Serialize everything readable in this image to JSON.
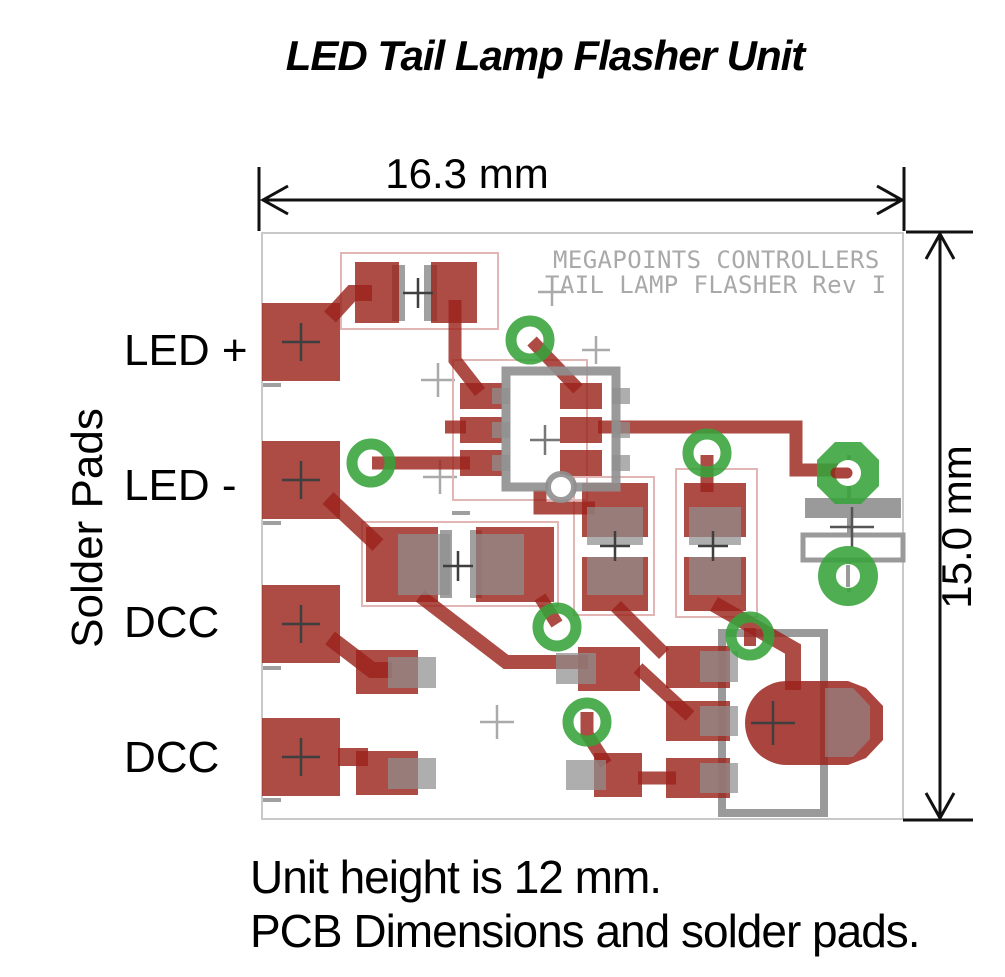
{
  "title": "LED Tail Lamp Flasher Unit",
  "dimensions": {
    "width_label": "16.3 mm",
    "height_label": "15.0 mm"
  },
  "side_label": "Solder Pads",
  "pad_labels": [
    {
      "label": "LED +"
    },
    {
      "label": "LED -"
    },
    {
      "label": "DCC"
    },
    {
      "label": "DCC"
    }
  ],
  "silkscreen": {
    "line1": "MEGAPOINTS CONTROLLERS",
    "line2": "TAIL LAMP FLASHER Rev I"
  },
  "footnotes": {
    "line1": "Unit height is 12 mm.",
    "line2": "PCB Dimensions and solder pads."
  },
  "colors": {
    "copper_red": "#9b231c",
    "component_gray": "#8f8f8f",
    "via_green": "#37a23a",
    "outline_pink": "#e3b6b6",
    "silkscreen_gray": "#a9a9a9",
    "board_border": "#c9c9c9",
    "dimension_black": "#111111"
  }
}
